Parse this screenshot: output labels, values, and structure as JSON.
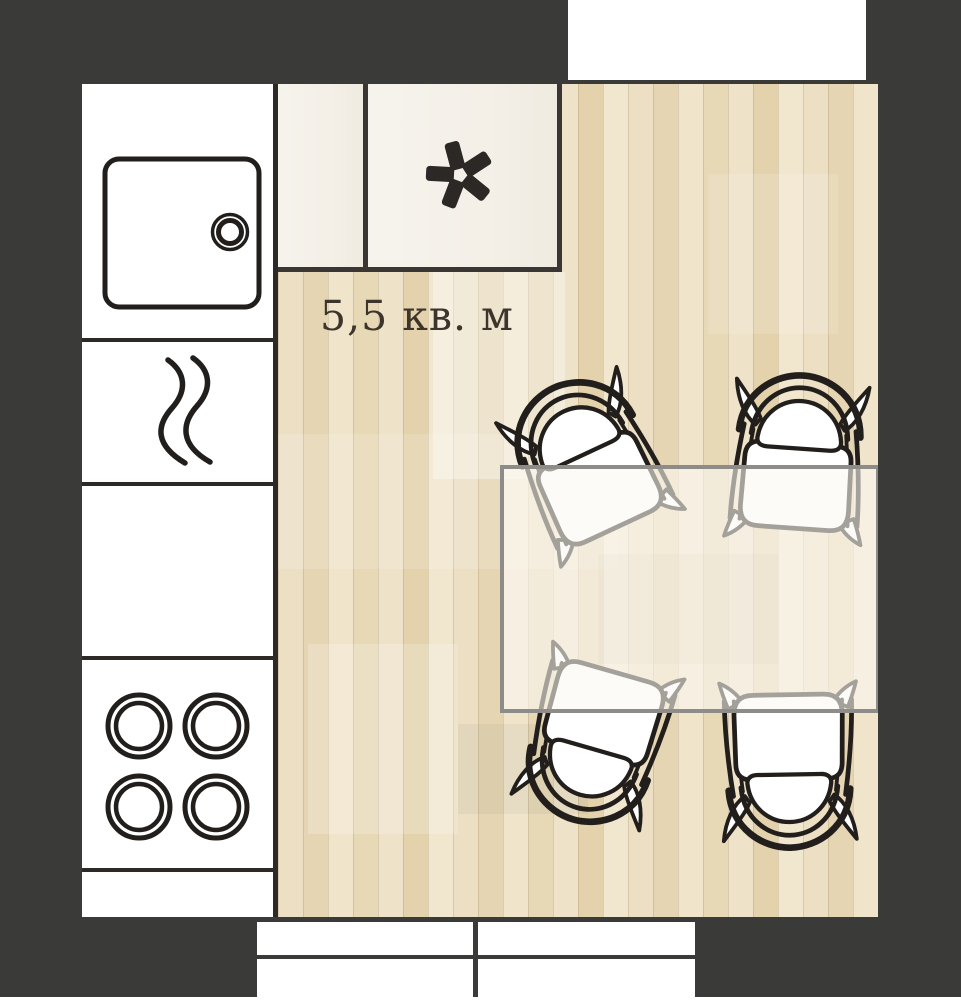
{
  "floorplan": {
    "area_label": "5,5 кв. м",
    "symbols": {
      "freezer_icon": "asterisk-snowflake",
      "sink_icon": "basin-with-round-drain",
      "heat_icon": "double-wave",
      "cooktop_icon": "four-burner-rings"
    },
    "counts": {
      "dining_chairs": 4,
      "cooktop_burners": 4,
      "base_cabinet_doors": 4,
      "wall_cabinets": 2
    },
    "colors": {
      "wall": "#3a3a38",
      "floor": "#e9dcc0",
      "fixture_line": "#2c2926",
      "chair_line": "#211e1b",
      "cabinet_cream": "#f4f0e8",
      "table_fill": "rgba(252,249,242,0.60)",
      "table_border": "#8e8c88",
      "label_text": "#3d352c",
      "white": "#ffffff"
    }
  }
}
